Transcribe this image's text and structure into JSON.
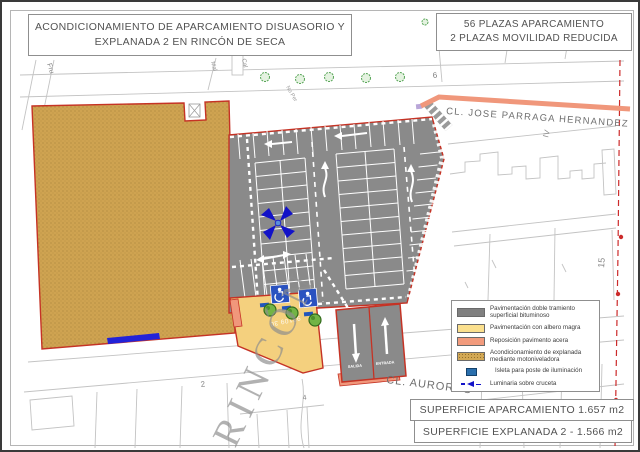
{
  "title_box": {
    "line1": "ACONDICIONAMIENTO DE APARCAMIENTO DISUASORIO Y",
    "line2": "EXPLANADA 2 EN RINCÓN DE SECA"
  },
  "plazas_box": {
    "line1": "56 PLAZAS APARCAMIENTO",
    "line2": "2 PLAZAS MOVILIDAD REDUCIDA"
  },
  "surface": {
    "aparcamiento": "SUPERFICIE APARCAMIENTO 1.657 m2",
    "explanada": "SUPERFICIE EXPLANADA 2 - 1.566 m2"
  },
  "legend": {
    "items": [
      {
        "key": "bituminoso",
        "color": "#808080",
        "label": "Pavimentación doble tramiento superficial bituminoso"
      },
      {
        "key": "albero",
        "color": "#fbe08e",
        "label": "Pavimentación con albero magra"
      },
      {
        "key": "acera",
        "color": "#f29b7d",
        "label": "Reposición pavimento acera"
      },
      {
        "key": "explanada",
        "color": "#d2a855",
        "label": "Acondicionamiento de explanada mediante motoniveladora"
      },
      {
        "key": "isleta",
        "color": "#2a6fad",
        "label": "Isleta para poste de iluminación"
      },
      {
        "key": "luminaria",
        "color": "#1212c8",
        "label": "Luminaria sobre cruceta"
      }
    ]
  },
  "streets": {
    "jose_parraga": "CL. JOSE PARRAGA HERNANDEZ",
    "auroros": "CL. AUROROS",
    "fru": "Fru",
    "cal": "Cal",
    "no_per": "No Per",
    "mal": "Mal"
  },
  "labels": {
    "rincon": "RINCÓN",
    "plot": "93109 30",
    "n6": "6",
    "niv": "IV",
    "n15": "15",
    "n4": "4",
    "n2": "2",
    "salida": "SALIDA",
    "entrada": "ENTRADA"
  },
  "colors": {
    "pavement_gray": "#8a8a8a",
    "albero_yellow": "#f4d07e",
    "acera_salmon": "#f0977b",
    "explanada_tan": "#cfa351",
    "site_border_red": "#c53325",
    "isleta_blue": "#2a52c0",
    "luminaria_blue": "#1212c8",
    "tree_green": "#72b445"
  }
}
